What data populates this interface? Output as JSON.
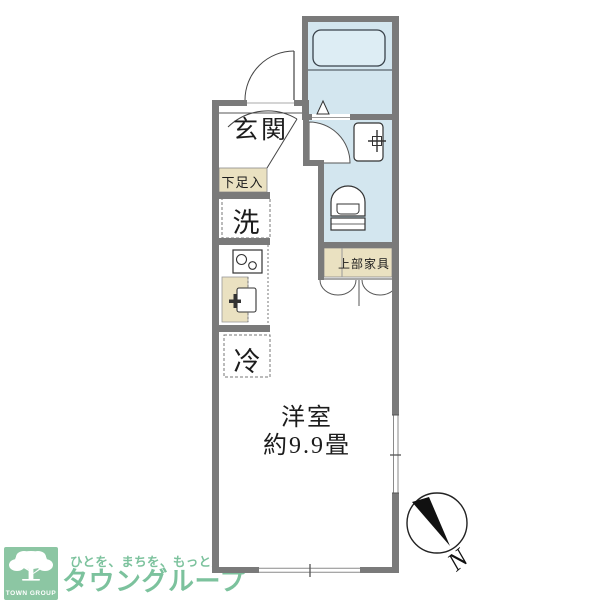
{
  "floorplan": {
    "labels": {
      "genkan": "玄関",
      "shoe_storage": "下足入",
      "washer": "洗",
      "fridge": "冷",
      "upper_cabinet": "上部家具",
      "room_name": "洋室",
      "room_size": "約9.9畳"
    },
    "fixtures": [
      "bathtub",
      "toilet",
      "washbasin",
      "stove",
      "kitchen-sink"
    ],
    "compass": {
      "north_label": "N"
    }
  },
  "branding": {
    "tagline": "ひとを、まちを、もっと豊かに。",
    "brand_name": "タウングループ",
    "logo_text": "TOWN GROUP"
  },
  "colors": {
    "wall": "#7a7a7a",
    "water_area": "#d3e6ef",
    "bathtub": "#ddedf4",
    "furniture": "#eae1c1",
    "brand_green": "#8cc6a3",
    "brand_text_green": "#7cc29d"
  }
}
